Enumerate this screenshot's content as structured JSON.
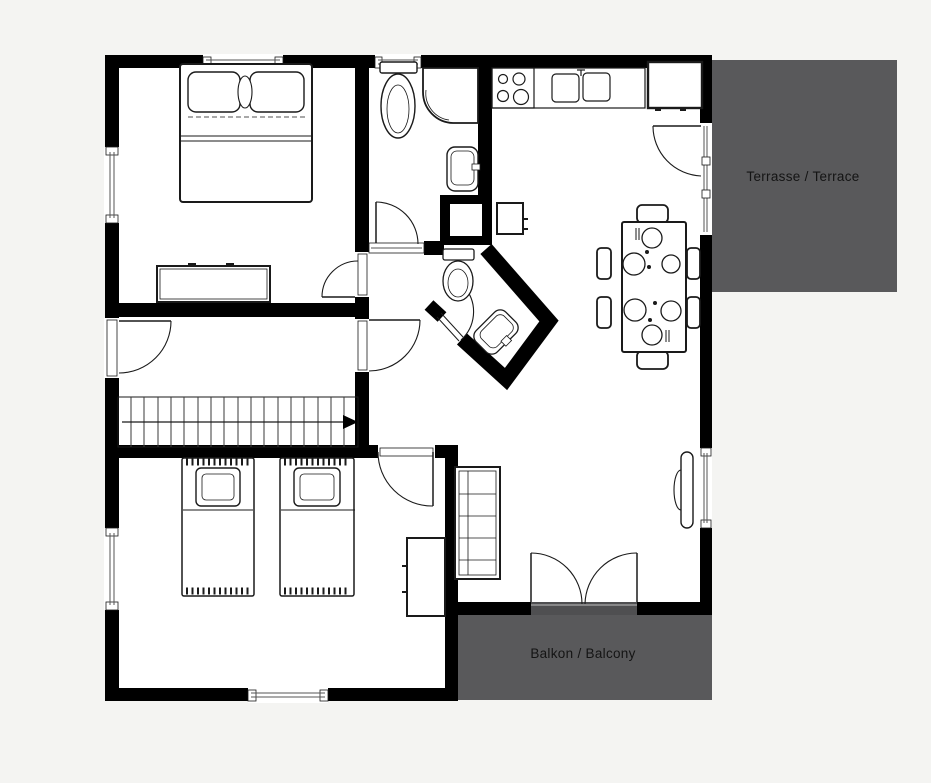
{
  "page": {
    "background": "#f4f4f2"
  },
  "plan": {
    "colors": {
      "wall": "#000000",
      "floor": "#ffffff",
      "outdoor_area": "#59595b",
      "line": "#1a1a1a"
    },
    "labels": {
      "terrace": "Terrasse / Terrace",
      "balcony": "Balkon / Balcony"
    },
    "stairs": {
      "direction_arrow": "right"
    },
    "rooms": [
      "bedroom-1",
      "bathroom",
      "wc",
      "kitchen-dining",
      "hallway",
      "stairs",
      "bedroom-2",
      "terrace",
      "balcony"
    ],
    "furniture": [
      "double-bed",
      "dresser",
      "toilet",
      "corner-shower",
      "washbasin",
      "kitchen-stove",
      "kitchen-sink",
      "refrigerator",
      "wall-cabinet",
      "dining-table",
      "dining-chairs",
      "wc-toilet",
      "wc-washbasin",
      "sideboard",
      "radiator",
      "single-bed-1",
      "single-bed-2",
      "wardrobe"
    ]
  }
}
